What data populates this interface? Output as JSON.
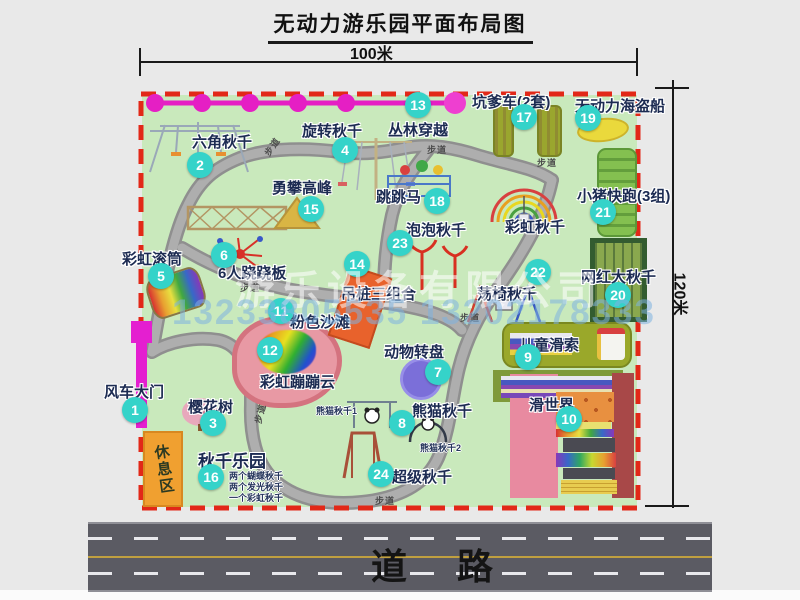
{
  "title": "无动力游乐园平面布局图",
  "dimensions": {
    "width": "100米",
    "height": "120米"
  },
  "road_label": "道路",
  "path_label": "步道",
  "rest_area_label": "休息区",
  "watermark": {
    "company": "游乐设备有限公司",
    "phones": "13233805535 13202178333"
  },
  "unnumbered": {
    "rainbow_swing": "彩虹秋千"
  },
  "colors": {
    "park_green": "#c9e9bc",
    "boundary_red": "#e22818",
    "badge_teal": "#35d3c9",
    "zipline_magenta": "#e51fc4",
    "road_gray": "#5b5b63"
  },
  "attractions": [
    {
      "num": "1",
      "label": "风车大门"
    },
    {
      "num": "2",
      "label": "六角秋千"
    },
    {
      "num": "3",
      "label": "樱花树"
    },
    {
      "num": "4",
      "label": "旋转秋千"
    },
    {
      "num": "5",
      "label": "彩虹滚筒"
    },
    {
      "num": "6",
      "label": "6人跷跷板"
    },
    {
      "num": "7",
      "label": "动物转盘"
    },
    {
      "num": "8",
      "label": "熊猫秋千",
      "sub1": "熊猫秋千1",
      "sub2": "熊猫秋千2"
    },
    {
      "num": "9",
      "label": "儿童滑索"
    },
    {
      "num": "10",
      "label": "滑世界"
    },
    {
      "num": "11",
      "label": "粉色沙滩"
    },
    {
      "num": "12",
      "label": "彩虹蹦蹦云"
    },
    {
      "num": "13",
      "label": "丛林穿越"
    },
    {
      "num": "14",
      "label": "吊桩三组合"
    },
    {
      "num": "15",
      "label": "勇攀高峰"
    },
    {
      "num": "16",
      "label": "秋千乐园",
      "notes": [
        "两个蝴蝶秋千",
        "两个发光秋千",
        "一个彩虹秋千"
      ]
    },
    {
      "num": "17",
      "label": "坑爹车(2套)"
    },
    {
      "num": "18",
      "label": "跳跳马"
    },
    {
      "num": "19",
      "label": "无动力海盗船"
    },
    {
      "num": "20",
      "label": "网红大秋千"
    },
    {
      "num": "21",
      "label": "小猪快跑(3组)"
    },
    {
      "num": "22",
      "label": "荡椅秋千"
    },
    {
      "num": "23",
      "label": "泡泡秋千"
    },
    {
      "num": "24",
      "label": "超级秋千"
    }
  ]
}
